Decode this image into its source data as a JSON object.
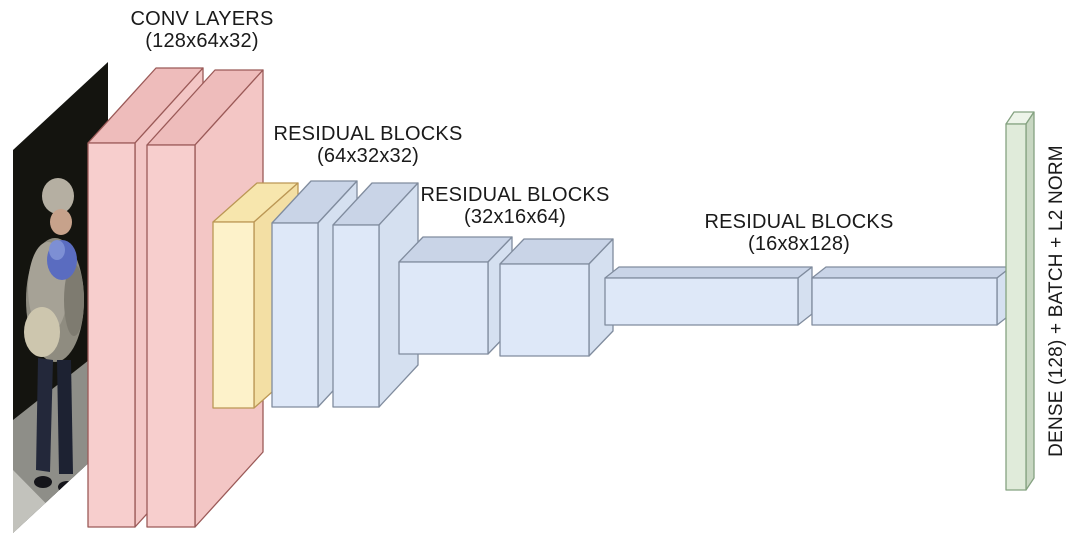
{
  "labels": {
    "conv": {
      "name": "CONV LAYERS",
      "dims": "(128x64x32)"
    },
    "res1": {
      "name": "RESIDUAL BLOCKS",
      "dims": "(64x32x32)"
    },
    "res2": {
      "name": "RESIDUAL BLOCKS",
      "dims": "(32x16x64)"
    },
    "res3": {
      "name": "RESIDUAL BLOCKS",
      "dims": "(16x8x128)"
    },
    "dense": {
      "name": "DENSE (128) + BATCH + L2 NORM"
    }
  },
  "blocks": [
    {
      "id": "input-photo",
      "kind": "input pedestrian image"
    },
    {
      "id": "conv-block-1",
      "group": "conv"
    },
    {
      "id": "conv-block-2",
      "group": "conv"
    },
    {
      "id": "pool-block",
      "group": "pool"
    },
    {
      "id": "residual-slab-1",
      "group": "res1"
    },
    {
      "id": "residual-slab-2",
      "group": "res1"
    },
    {
      "id": "residual-cube-1",
      "group": "res2"
    },
    {
      "id": "residual-cube-2",
      "group": "res2"
    },
    {
      "id": "residual-bar-1",
      "group": "res3"
    },
    {
      "id": "residual-bar-2",
      "group": "res3"
    },
    {
      "id": "dense-bar",
      "group": "dense"
    }
  ],
  "colors": {
    "background": "#ffffff",
    "label-text": "#1a1a1a",
    "conv-front": "#f7cecd",
    "conv-top": "#eebcbb",
    "conv-side": "#f3c6c5",
    "conv-stroke": "#9b5a58",
    "pool-front": "#fdf2ca",
    "pool-top": "#f7e6ad",
    "pool-side": "#f3dfa4",
    "pool-stroke": "#bb9755",
    "res-front": "#dee8f8",
    "res-top": "#c9d4e7",
    "res-side": "#d5e0f0",
    "res-stroke": "#808c9e",
    "dense-front": "#e0ebda",
    "dense-top": "#edf4e9",
    "dense-side": "#c8d7c2",
    "dense-stroke": "#85a281"
  }
}
